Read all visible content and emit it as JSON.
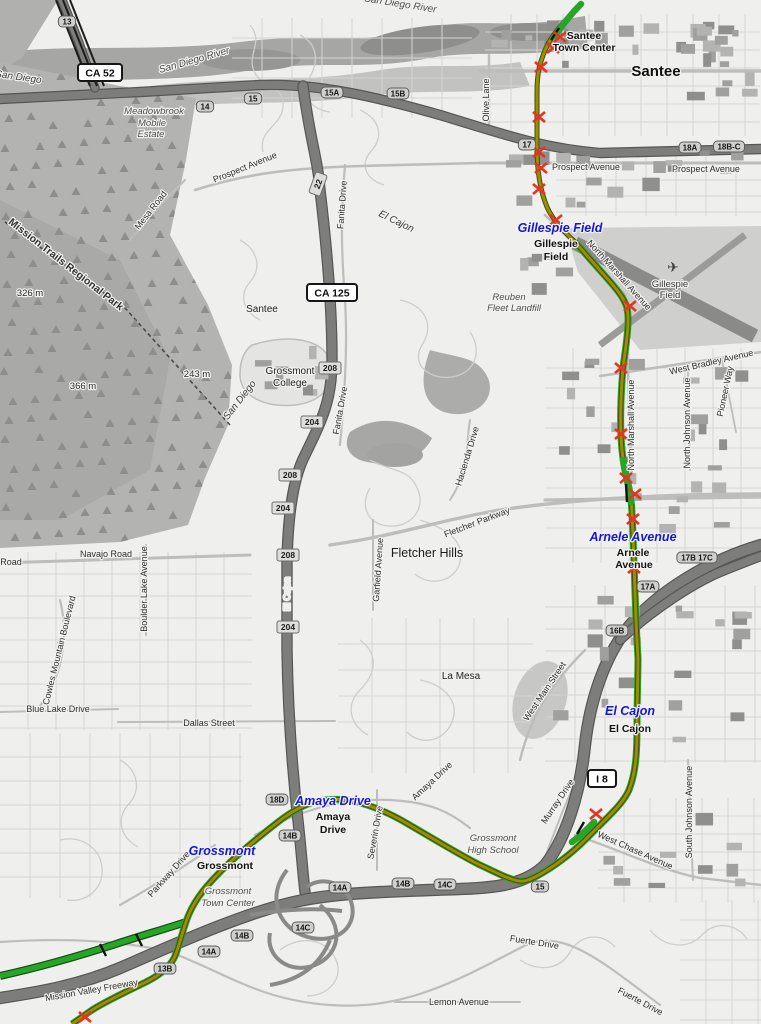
{
  "map": {
    "title": "Trolley line map — Santee to Grossmont",
    "colors": {
      "background": "#efefed",
      "route_olive": "#9a8f00",
      "route_casing": "#4a4a10",
      "line_green": "#28a428",
      "green_casing": "#135013",
      "crossing_red": "#e63323",
      "station_blue": "#1414dc",
      "freeway_gray": "#7d7d7b",
      "park_gray": "#b3b3b1"
    },
    "stations": [
      {
        "name": "Gillespie Field",
        "x": 560,
        "y": 232
      },
      {
        "name": "Arnele Avenue",
        "x": 633,
        "y": 541
      },
      {
        "name": "El Cajon",
        "x": 630,
        "y": 715
      },
      {
        "name": "Amaya Drive",
        "x": 333,
        "y": 805
      },
      {
        "name": "Grossmont",
        "x": 222,
        "y": 855
      }
    ],
    "labels": [
      {
        "t": "San Diego River",
        "x": 195,
        "y": 63,
        "r": -16,
        "c": "water"
      },
      {
        "t": "San Diego River",
        "x": 400,
        "y": 7,
        "r": 9,
        "c": "water"
      },
      {
        "t": "Mission Trails Regional Park",
        "x": 64,
        "y": 267,
        "r": 38,
        "c": "park"
      },
      {
        "t": "Meadowbrook",
        "x": 154,
        "y": 114,
        "c": "igray"
      },
      {
        "t": "Mobile",
        "x": 152,
        "y": 126,
        "c": "igray"
      },
      {
        "t": "Estate",
        "x": 151,
        "y": 137,
        "c": "igray"
      },
      {
        "t": "Reuben",
        "x": 509,
        "y": 300,
        "c": "igray"
      },
      {
        "t": "Fleet Landfill",
        "x": 514,
        "y": 311,
        "c": "igray"
      },
      {
        "t": "Grossmont",
        "x": 493,
        "y": 841,
        "c": "igray"
      },
      {
        "t": "High School",
        "x": 493,
        "y": 853,
        "c": "igray"
      },
      {
        "t": "Grossmont",
        "x": 228,
        "y": 894,
        "c": "igray"
      },
      {
        "t": "Town Center",
        "x": 228,
        "y": 906,
        "c": "igray"
      },
      {
        "t": "Gillespie",
        "x": 670,
        "y": 287,
        "c": "apt"
      },
      {
        "t": "Field",
        "x": 670,
        "y": 298,
        "c": "apt"
      },
      {
        "t": "Santee",
        "x": 656,
        "y": 76,
        "c": "city"
      },
      {
        "t": "Santee",
        "x": 262,
        "y": 312,
        "c": "place"
      },
      {
        "t": "Fletcher Hills",
        "x": 427,
        "y": 557,
        "c": "placelg"
      },
      {
        "t": "La Mesa",
        "x": 461,
        "y": 679,
        "c": "place"
      },
      {
        "t": "Grossmont",
        "x": 290,
        "y": 374,
        "c": "place"
      },
      {
        "t": "College",
        "x": 290,
        "y": 386,
        "c": "place"
      },
      {
        "t": "El Cajon",
        "x": 395,
        "y": 224,
        "r": 26,
        "c": "bnd"
      },
      {
        "t": "San Diego",
        "x": 242,
        "y": 402,
        "r": -52,
        "c": "bnd"
      },
      {
        "t": "San Diego",
        "x": 18,
        "y": 80,
        "r": 8,
        "c": "bnd"
      },
      {
        "t": "El Cajon",
        "x": 290,
        "y": 594,
        "r": -90,
        "c": "onfwy"
      },
      {
        "t": "Santee",
        "x": 584,
        "y": 39,
        "c": "pbold"
      },
      {
        "t": "Town Center",
        "x": 584,
        "y": 51,
        "c": "pbold"
      },
      {
        "t": "Gillespie",
        "x": 556,
        "y": 247,
        "c": "pbold"
      },
      {
        "t": "Field",
        "x": 556,
        "y": 260,
        "c": "pbold"
      },
      {
        "t": "Arnele",
        "x": 633,
        "y": 556,
        "c": "pbold"
      },
      {
        "t": "Avenue",
        "x": 634,
        "y": 568,
        "c": "pbold"
      },
      {
        "t": "El Cajon",
        "x": 630,
        "y": 732,
        "c": "pbold"
      },
      {
        "t": "Amaya",
        "x": 333,
        "y": 820,
        "c": "pbold"
      },
      {
        "t": "Drive",
        "x": 333,
        "y": 833,
        "c": "pbold"
      },
      {
        "t": "Grossmont",
        "x": 225,
        "y": 869,
        "c": "pbold"
      },
      {
        "t": "Prospect Avenue",
        "x": 246,
        "y": 170,
        "r": -22,
        "c": "road"
      },
      {
        "t": "Prospect Avenue",
        "x": 586,
        "y": 170,
        "c": "road"
      },
      {
        "t": "Prospect Avenue",
        "x": 706,
        "y": 172,
        "c": "road"
      },
      {
        "t": "Olive Lane",
        "x": 489,
        "y": 100,
        "r": -90,
        "c": "road"
      },
      {
        "t": "North Marshall Avenue",
        "x": 617,
        "y": 277,
        "r": 48,
        "c": "road"
      },
      {
        "t": "North Marshall Avenue",
        "x": 634,
        "y": 425,
        "r": -90,
        "c": "road"
      },
      {
        "t": "West Bradley Avenue",
        "x": 712,
        "y": 365,
        "r": -13,
        "c": "road"
      },
      {
        "t": "North Johnson Avenue",
        "x": 690,
        "y": 423,
        "r": -90,
        "c": "road"
      },
      {
        "t": "Pioneer Way",
        "x": 728,
        "y": 392,
        "r": -78,
        "c": "road"
      },
      {
        "t": "Fanita Drive",
        "x": 345,
        "y": 205,
        "r": -86,
        "c": "road"
      },
      {
        "t": "Fanita Drive",
        "x": 343,
        "y": 411,
        "r": -80,
        "c": "road"
      },
      {
        "t": "Mesa Road",
        "x": 153,
        "y": 212,
        "r": -52,
        "c": "road"
      },
      {
        "t": "Navajo Road",
        "x": 106,
        "y": 557,
        "c": "road"
      },
      {
        "t": "Road",
        "x": 11,
        "y": 565,
        "c": "road"
      },
      {
        "t": "Cowles Mountain Boulevard",
        "x": 62,
        "y": 651,
        "r": -76,
        "c": "road"
      },
      {
        "t": "Boulder Lake Avenue",
        "x": 147,
        "y": 589,
        "r": -90,
        "c": "road"
      },
      {
        "t": "Blue Lake Drive",
        "x": 58,
        "y": 712,
        "c": "road"
      },
      {
        "t": "Dallas Street",
        "x": 209,
        "y": 726,
        "c": "road"
      },
      {
        "t": "Fletcher Parkway",
        "x": 478,
        "y": 525,
        "r": -21,
        "c": "road"
      },
      {
        "t": "Garfield Avenue",
        "x": 381,
        "y": 570,
        "r": -86,
        "c": "road"
      },
      {
        "t": "Hacienda Drive",
        "x": 470,
        "y": 457,
        "r": -73,
        "c": "road"
      },
      {
        "t": "West Main Street",
        "x": 547,
        "y": 693,
        "r": -56,
        "c": "road"
      },
      {
        "t": "Severin Drive",
        "x": 378,
        "y": 833,
        "r": -80,
        "c": "road"
      },
      {
        "t": "Murray Drive",
        "x": 560,
        "y": 803,
        "r": -56,
        "c": "road"
      },
      {
        "t": "Amaya Drive",
        "x": 434,
        "y": 783,
        "r": -43,
        "c": "road"
      },
      {
        "t": "West Chase Avenue",
        "x": 634,
        "y": 853,
        "r": 24,
        "c": "road"
      },
      {
        "t": "South Johnson Avenue",
        "x": 692,
        "y": 812,
        "r": -90,
        "c": "road"
      },
      {
        "t": "Parkway Drive",
        "x": 171,
        "y": 876,
        "r": -48,
        "c": "road"
      },
      {
        "t": "Mission Valley Freeway",
        "x": 92,
        "y": 993,
        "r": -10,
        "c": "road"
      },
      {
        "t": "Fuerte Drive",
        "x": 534,
        "y": 945,
        "r": 9,
        "c": "road"
      },
      {
        "t": "Fuerte Drive",
        "x": 639,
        "y": 1004,
        "r": 28,
        "c": "road"
      },
      {
        "t": "Lemon Avenue",
        "x": 459,
        "y": 1005,
        "c": "road"
      },
      {
        "t": "326 m",
        "x": 30,
        "y": 296,
        "c": "peak"
      },
      {
        "t": "366 m",
        "x": 83,
        "y": 389,
        "c": "peak"
      },
      {
        "t": "243 m",
        "x": 197,
        "y": 377,
        "c": "peak"
      }
    ],
    "highway_shields": [
      {
        "text": "CA 52",
        "x": 100,
        "y": 73,
        "w": 44
      },
      {
        "text": "CA 125",
        "x": 332,
        "y": 293,
        "w": 50
      },
      {
        "text": "I 8",
        "x": 602,
        "y": 779,
        "w": 28
      }
    ],
    "route_shields": [
      {
        "text": "22",
        "x": 318,
        "y": 184,
        "r": -70
      },
      {
        "text": "208",
        "x": 330,
        "y": 368
      },
      {
        "text": "204",
        "x": 312,
        "y": 422
      },
      {
        "text": "208",
        "x": 290,
        "y": 475
      },
      {
        "text": "204",
        "x": 283,
        "y": 508
      },
      {
        "text": "208",
        "x": 288,
        "y": 555
      },
      {
        "text": "204",
        "x": 288,
        "y": 627
      }
    ],
    "exit_labels": [
      {
        "text": "13",
        "x": 67,
        "y": 22
      },
      {
        "text": "14",
        "x": 205,
        "y": 107
      },
      {
        "text": "15",
        "x": 253,
        "y": 99
      },
      {
        "text": "15A",
        "x": 332,
        "y": 93
      },
      {
        "text": "15B",
        "x": 398,
        "y": 94
      },
      {
        "text": "17",
        "x": 527,
        "y": 145
      },
      {
        "text": "18A",
        "x": 690,
        "y": 148
      },
      {
        "text": "18B-C",
        "x": 729,
        "y": 147
      },
      {
        "text": "17B 17C",
        "x": 697,
        "y": 558
      },
      {
        "text": "17A",
        "x": 648,
        "y": 587
      },
      {
        "text": "16B",
        "x": 617,
        "y": 631
      },
      {
        "text": "18D",
        "x": 277,
        "y": 800
      },
      {
        "text": "14B",
        "x": 290,
        "y": 836
      },
      {
        "text": "14A",
        "x": 340,
        "y": 888
      },
      {
        "text": "14B",
        "x": 403,
        "y": 884
      },
      {
        "text": "14C",
        "x": 445,
        "y": 885
      },
      {
        "text": "15",
        "x": 540,
        "y": 887
      },
      {
        "text": "14C",
        "x": 303,
        "y": 928
      },
      {
        "text": "14B",
        "x": 242,
        "y": 936
      },
      {
        "text": "14A",
        "x": 209,
        "y": 952
      },
      {
        "text": "13B",
        "x": 165,
        "y": 969
      }
    ],
    "crossings": [
      [
        560,
        37
      ],
      [
        553,
        48
      ],
      [
        541,
        67
      ],
      [
        539,
        117
      ],
      [
        539,
        152
      ],
      [
        541,
        168
      ],
      [
        539,
        189
      ],
      [
        556,
        220
      ],
      [
        630,
        306
      ],
      [
        621,
        368
      ],
      [
        621,
        434
      ],
      [
        626,
        478
      ],
      [
        635,
        494
      ],
      [
        633,
        519
      ],
      [
        634,
        568
      ],
      [
        596,
        814
      ],
      [
        85,
        1017
      ]
    ],
    "route_paths": {
      "olive_upper": "M577,8 C566,20 552,34 546,48 C540,62 537,72 537,92 L537,148 C537,170 540,190 547,207 C552,218 560,228 575,242",
      "olive_lower": "M575,242 L598,268 C612,284 624,296 627,308 C630,322 626,344 623,368 C621,392 620,414 621,436 C622,458 625,472 629,488 C632,502 632,514 633,534 L635,592 C636,625 637,642 638,658 C638,676 637,700 637,726 C637,752 636,772 629,790 C624,801 615,810 605,820 L585,840 C570,855 552,868 537,876 C531,879 525,882 519,881 C508,879 495,872 478,864 C460,855 432,838 408,824 C388,812 368,804 348,800 C338,799 328,799 318,801 C305,804 292,811 278,822 C260,836 240,852 222,870 C207,885 196,898 189,914 C183,928 180,944 175,956 C170,968 158,976 146,982 C128,991 108,1000 92,1010 L72,1024",
      "green_tail_north": "M581,4 C573,12 563,24 555,36",
      "green_branch_west": "M186,922 C165,929 140,936 116,944 C85,954 45,966 0,976",
      "green_segment_arnele": "M623,460 C626,474 629,486 631,502",
      "green_segment_chase": "M594,822 C588,829 580,836 572,842"
    },
    "poi_icons": [
      {
        "icon": "airplane-icon",
        "glyph": "✈",
        "x": 673,
        "y": 272,
        "size": 14
      }
    ]
  }
}
